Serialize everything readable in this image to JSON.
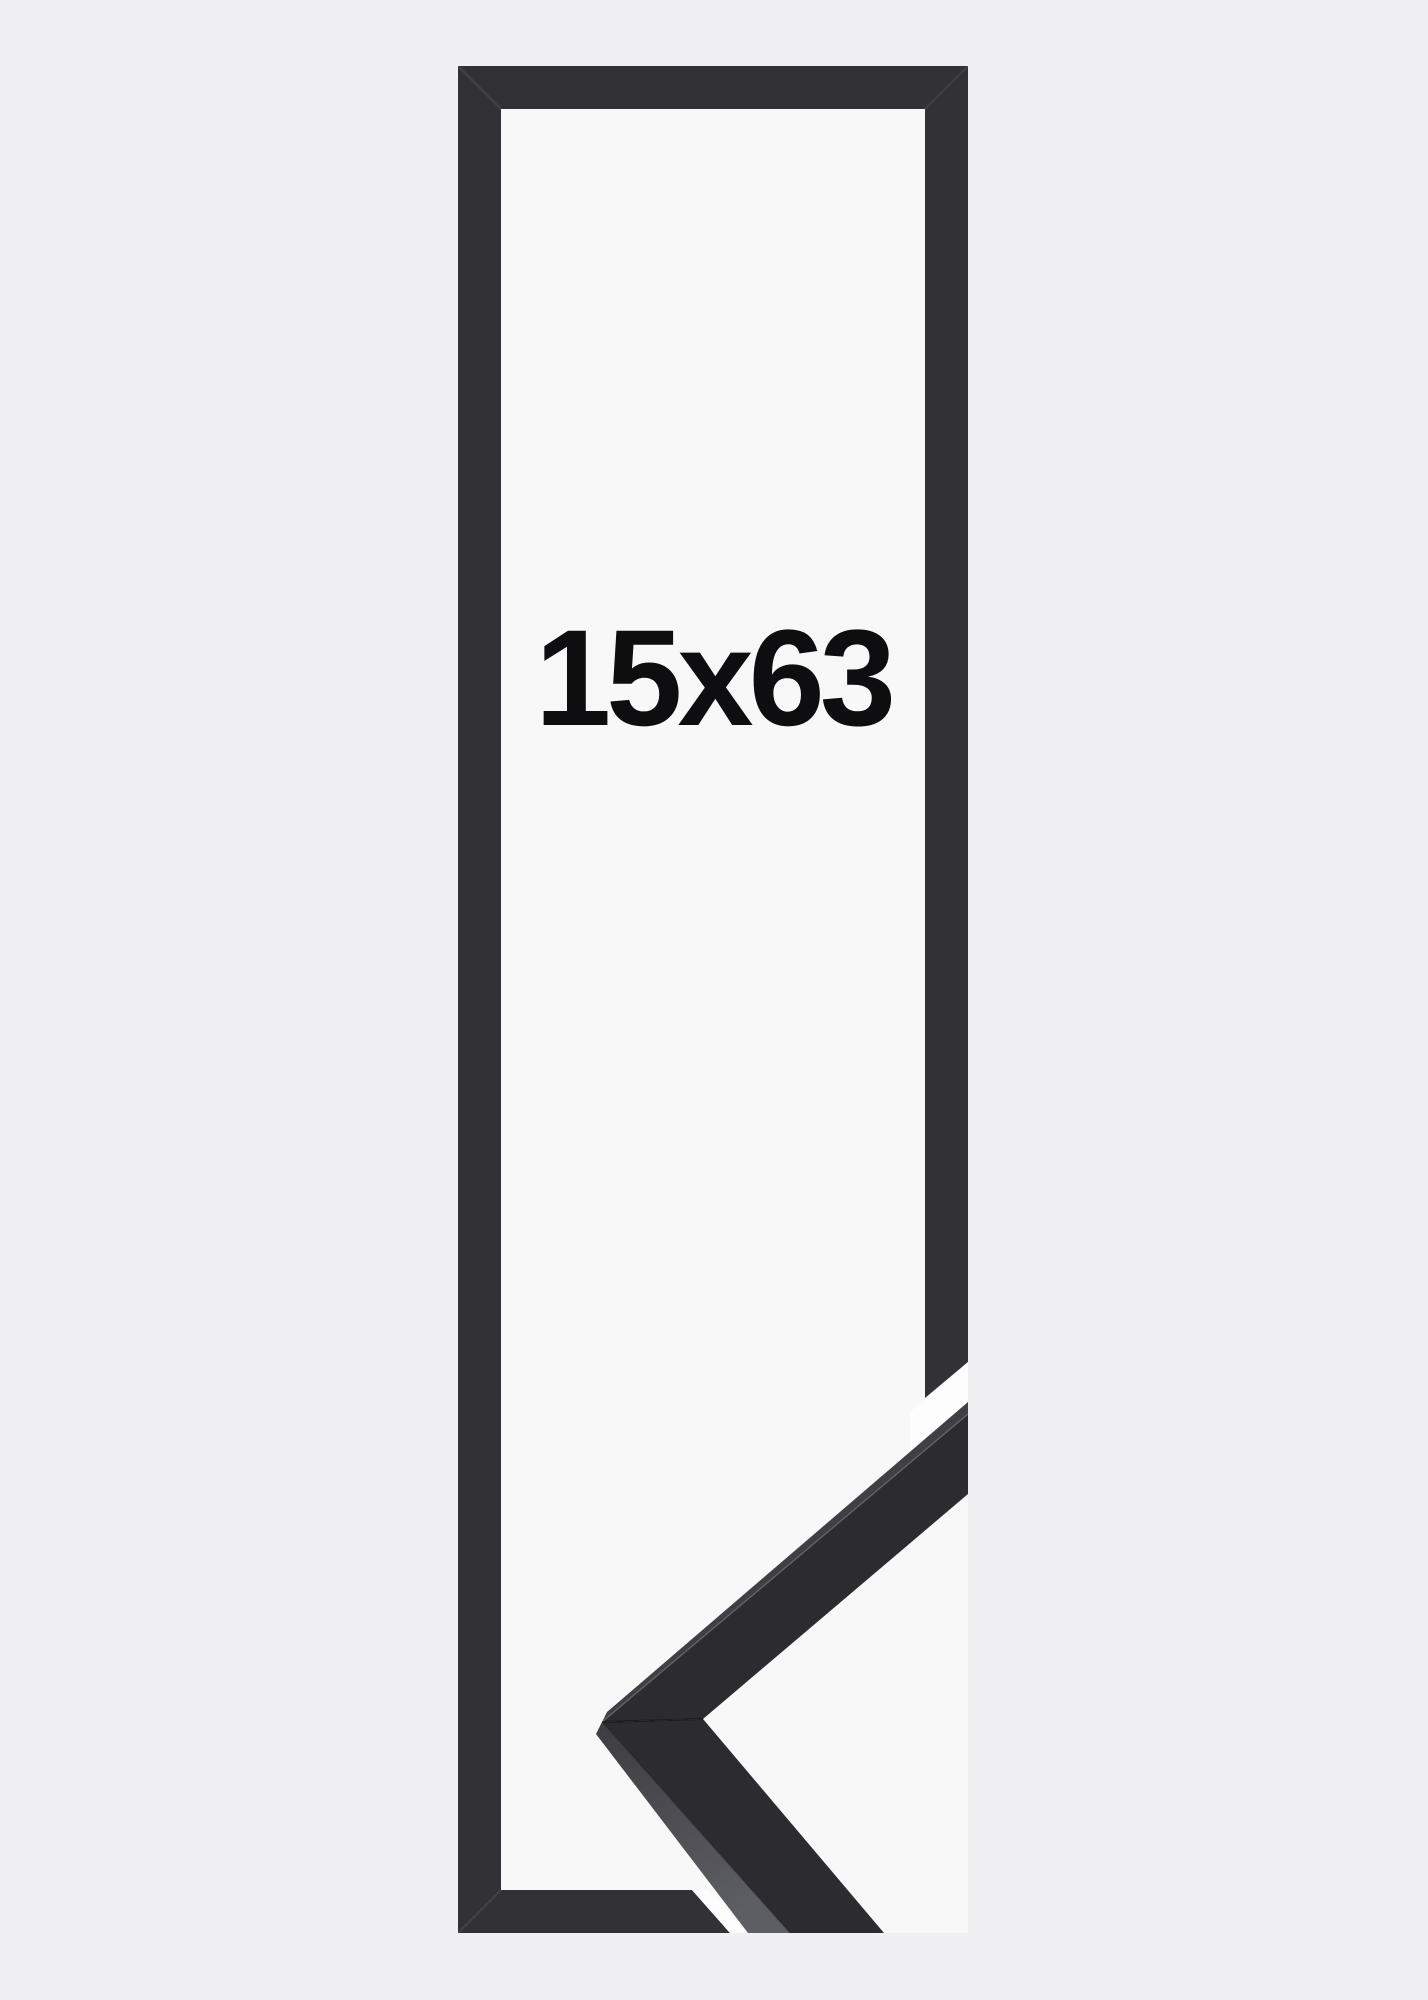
{
  "product": {
    "size_label": "15x63"
  },
  "colors": {
    "background": "#f0f0f2",
    "photo_bg": "#f8f8f9",
    "gap_white": "#fdfdfe",
    "frame": "#323236",
    "moulding_face": "#2c2c30",
    "moulding_top_strip": "#3f3f45",
    "moulding_side_top": "#3c3c41",
    "moulding_side_bottom": "#5d5d64",
    "label": "#0e0e10"
  }
}
